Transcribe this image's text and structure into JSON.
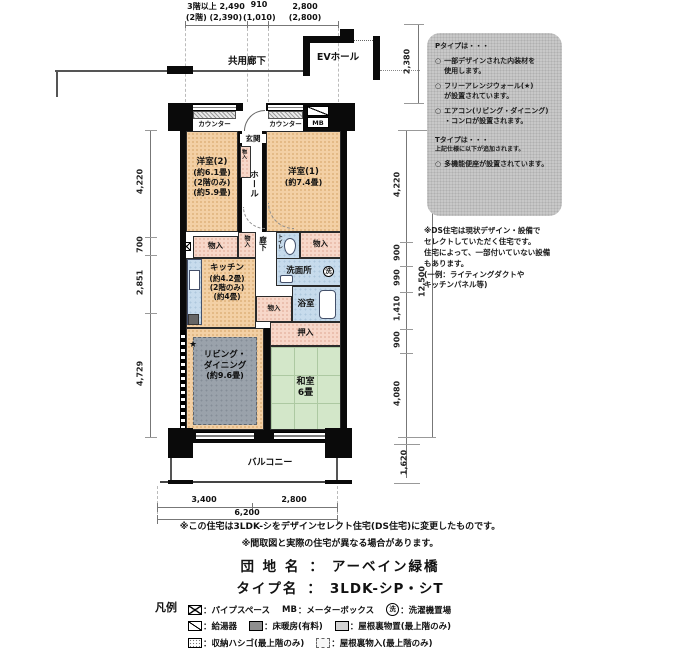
{
  "header": {
    "dims_row1": [
      "3階以上 2,490",
      "910",
      "2,800"
    ],
    "dims_row2": [
      "(2階) (2,390)",
      "(1,010)",
      "(2,800)"
    ],
    "common_corridor": "共用廊下",
    "ev_hall": "EVホール"
  },
  "plan": {
    "counter_left": "カウンター",
    "counter_right": "カウンター",
    "mb_label": "MB",
    "genkan": "玄関",
    "hall": "ホール",
    "shoe_storage": "物入",
    "room2": {
      "name": "洋室(2)",
      "area": "(約6.1畳)",
      "floor_note": "(2階のみ)",
      "area2": "(約5.9畳)"
    },
    "room1": {
      "name": "洋室(1)",
      "area": "(約7.4畳)"
    },
    "storage_left": "物入",
    "storage_mid": "物入",
    "storage_right": "物入",
    "storage_small": "物入",
    "corridor": "廊下",
    "toilet": "トイレ",
    "kitchen": {
      "name": "キッチン",
      "area": "(約4.2畳)",
      "floor_note": "(2階のみ)",
      "area2": "(約4畳)"
    },
    "washroom": "洗面所",
    "wash_symbol": "洗",
    "bath": "浴室",
    "oshiire": "押入",
    "living": {
      "star": "★",
      "name1": "リビング・",
      "name2": "ダイニング",
      "area": "(約9.6畳)"
    },
    "washitsu": {
      "name": "和室",
      "area": "6畳"
    },
    "balcony": "バルコニー"
  },
  "dims": {
    "left": [
      "4,220",
      "700",
      "2,851",
      "4,729"
    ],
    "right": [
      "4,220",
      "900",
      "990",
      "1,410",
      "900",
      "4,080"
    ],
    "right_total": "12,500",
    "right_top": "2,380",
    "balcony_depth": "1,620",
    "bottom": [
      "3,400",
      "2,800"
    ],
    "bottom_total": "6,200"
  },
  "info_box": {
    "p_title": "Pタイプは・・・",
    "bullet": "○",
    "p_items": [
      "一部デザインされた内装材を\n使用します。",
      "フリーアレンジウォール(★)\nが設置されています。",
      "エアコン(リビング・ダイニング)\n・コンロが設置されます。"
    ],
    "t_title": "Tタイプは・・・",
    "t_sub": "上記仕様に以下が追加されます。",
    "t_items": [
      "多機能便座が設置されています。"
    ]
  },
  "ds_note": "※DS住宅は現状デザイン・設備で\nセレクトしていただく住宅です。\n住宅によって、一部付いていない設備\nもあります。\n(一例：ライティングダクトや\nキッチンパネル等)",
  "notes": [
    "※この住宅は3LDK-シをデザインセレクト住宅(DS住宅)に変更したものです。",
    "※間取図と実際の住宅が異なる場合があります。"
  ],
  "title_block": {
    "estate_label": "団 地 名",
    "colon": "：",
    "estate_name": "アーベイン緑橋",
    "type_label": "タイプ名",
    "type_name": "3LDK-シP・シT"
  },
  "legend": {
    "title": "凡例",
    "mb_prefix": "MB",
    "wash_glyph": "洗",
    "labels": {
      "pipe_space": "：パイプスペース",
      "meter_box": "：メーターボックス",
      "washer": "：洗濯機置場",
      "water_heater": "：給湯器",
      "floor_heating": "：床暖房(有料)",
      "attic_storage": "：屋根裏物置(最上階のみ)",
      "storage_ladder": "：収納ハシゴ(最上階のみ)",
      "attic_closet": "：屋根裏物入(最上階のみ)"
    }
  },
  "colors": {
    "room": "#f3d0a5",
    "closet": "#f7d7c9",
    "wet": "#c7dbec",
    "tatami": "#d3e7c9",
    "carpet": "#9aa2ab",
    "panel": "#c8c8c8"
  }
}
